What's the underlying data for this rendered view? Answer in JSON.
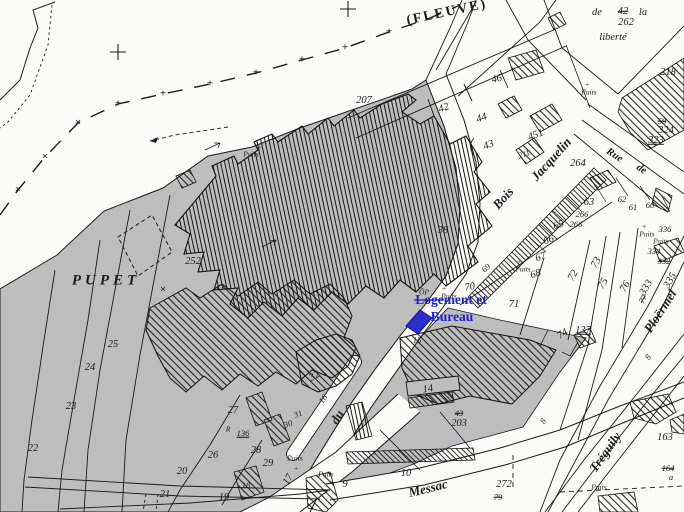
{
  "map": {
    "type": "cadastral-plan-scan",
    "area_name": "PUPET",
    "river_label": "(FLEUVE)",
    "place_labels": {
      "liberte_line1": "de",
      "liberte_old": "42",
      "liberte_line1b": "la",
      "liberte_new": "262",
      "liberte_line2": "liberté"
    },
    "streets": [
      "Bois Jacquelin",
      "Rue de",
      "du",
      "Messac",
      "Tréguily",
      "Ploërmel"
    ],
    "well_label": "Puits"
  },
  "annotation": {
    "line1": "Logement et",
    "line2": "Bureau",
    "color": "#1e22c8"
  },
  "colors": {
    "shade_gray": "#bdbdbd",
    "ink": "#1b1b1b",
    "paper": "#fbfbf8",
    "annotation_blue": "#2a2ecf"
  },
  "map_labels": [
    {
      "name": "river-label",
      "t": "(FLEUVE)",
      "x": 447,
      "y": 13,
      "r": -12,
      "c": "st2"
    },
    {
      "name": "area-label-pupet",
      "t": "PUPET",
      "x": 106,
      "y": 281,
      "r": 0,
      "c": "pupet"
    },
    {
      "name": "boundary-plus",
      "t": "+",
      "x": 118,
      "y": 104,
      "r": 0,
      "c": "mk"
    },
    {
      "name": "boundary-plus",
      "t": "+",
      "x": 163,
      "y": 94,
      "r": 0,
      "c": "mk"
    },
    {
      "name": "boundary-plus",
      "t": "+",
      "x": 210,
      "y": 84,
      "r": 0,
      "c": "mk"
    },
    {
      "name": "boundary-plus",
      "t": "+",
      "x": 256,
      "y": 73,
      "r": 0,
      "c": "mk"
    },
    {
      "name": "boundary-plus",
      "t": "+",
      "x": 302,
      "y": 60,
      "r": 0,
      "c": "mk"
    },
    {
      "name": "boundary-plus",
      "t": "+",
      "x": 345,
      "y": 48,
      "r": 0,
      "c": "mk"
    },
    {
      "name": "boundary-plus",
      "t": "+",
      "x": 389,
      "y": 32,
      "r": 0,
      "c": "mk"
    },
    {
      "name": "boundary-cross",
      "t": "×",
      "x": 18,
      "y": 190,
      "r": 0,
      "c": "mk"
    },
    {
      "name": "boundary-cross",
      "t": "×",
      "x": 45,
      "y": 157,
      "r": 0,
      "c": "mk"
    },
    {
      "name": "boundary-cross",
      "t": "×",
      "x": 78,
      "y": 123,
      "r": 0,
      "c": "mk"
    },
    {
      "name": "survey-cross",
      "t": "×",
      "x": 163,
      "y": 290,
      "r": 0,
      "c": "mk"
    },
    {
      "name": "place-word",
      "t": "de",
      "x": 597,
      "y": 13,
      "r": 0,
      "c": "n"
    },
    {
      "name": "parcel-old",
      "t": "42",
      "x": 623,
      "y": 12,
      "r": 0,
      "c": "n strike"
    },
    {
      "name": "place-word",
      "t": "la",
      "x": 643,
      "y": 13,
      "r": 0,
      "c": "n"
    },
    {
      "name": "parcel",
      "t": "262",
      "x": 626,
      "y": 23,
      "r": 0,
      "c": "n"
    },
    {
      "name": "place-word",
      "t": "liberté",
      "x": 613,
      "y": 38,
      "r": 0,
      "c": "n"
    },
    {
      "name": "parcel",
      "t": "218",
      "x": 668,
      "y": 73,
      "r": 0,
      "c": "n"
    },
    {
      "name": "parcel-old",
      "t": "59",
      "x": 662,
      "y": 121,
      "r": 0,
      "c": "ns strike"
    },
    {
      "name": "parcel",
      "t": "324",
      "x": 666,
      "y": 131,
      "r": 0,
      "c": "n"
    },
    {
      "name": "parcel",
      "t": "323",
      "x": 656,
      "y": 141,
      "r": 0,
      "c": "n u"
    },
    {
      "name": "street-label",
      "t": "Rue",
      "x": 614,
      "y": 156,
      "r": 33,
      "c": "stm"
    },
    {
      "name": "street-label",
      "t": "de",
      "x": 641,
      "y": 170,
      "r": 33,
      "c": "stm"
    },
    {
      "name": "parcel",
      "t": "264",
      "x": 578,
      "y": 164,
      "r": 0,
      "c": "n"
    },
    {
      "name": "parcel",
      "t": "63",
      "x": 589,
      "y": 203,
      "r": 0,
      "c": "n"
    },
    {
      "name": "parcel",
      "t": "266",
      "x": 582,
      "y": 214,
      "r": 0,
      "c": "ns"
    },
    {
      "name": "parcel",
      "t": "266",
      "x": 576,
      "y": 224,
      "r": 0,
      "c": "ns"
    },
    {
      "name": "parcel",
      "t": "62",
      "x": 622,
      "y": 199,
      "r": 0,
      "c": "ns"
    },
    {
      "name": "parcel",
      "t": "61",
      "x": 633,
      "y": 207,
      "r": 0,
      "c": "ns"
    },
    {
      "name": "parcel",
      "t": "60",
      "x": 650,
      "y": 205,
      "r": 0,
      "c": "ns"
    },
    {
      "name": "parcel",
      "t": "336",
      "x": 665,
      "y": 229,
      "r": 0,
      "c": "ns"
    },
    {
      "name": "parcel",
      "t": "334",
      "x": 654,
      "y": 251,
      "r": 0,
      "c": "ns"
    },
    {
      "name": "parcel-old",
      "t": "332",
      "x": 664,
      "y": 261,
      "r": 0,
      "c": "ns strike"
    },
    {
      "name": "well-cross",
      "t": "+",
      "x": 644,
      "y": 226,
      "r": 0,
      "c": "tiny"
    },
    {
      "name": "well-label",
      "t": "Puits",
      "x": 647,
      "y": 234,
      "r": 0,
      "c": "tiny"
    },
    {
      "name": "well-label",
      "t": "Puits",
      "x": 661,
      "y": 241,
      "r": 0,
      "c": "tiny"
    },
    {
      "name": "well-cross",
      "t": "+",
      "x": 587,
      "y": 84,
      "r": 0,
      "c": "tiny"
    },
    {
      "name": "well-label",
      "t": "Puits",
      "x": 589,
      "y": 92,
      "r": 0,
      "c": "tiny"
    },
    {
      "name": "parcel",
      "t": "207",
      "x": 364,
      "y": 101,
      "r": 0,
      "c": "n"
    },
    {
      "name": "parcel",
      "t": "42",
      "x": 444,
      "y": 109,
      "r": -20,
      "c": "n"
    },
    {
      "name": "parcel",
      "t": "44",
      "x": 482,
      "y": 119,
      "r": -20,
      "c": "n"
    },
    {
      "name": "parcel",
      "t": "43",
      "x": 489,
      "y": 146,
      "r": -20,
      "c": "n"
    },
    {
      "name": "parcel",
      "t": "451",
      "x": 536,
      "y": 136,
      "r": -20,
      "c": "n"
    },
    {
      "name": "parcel",
      "t": "211",
      "x": 524,
      "y": 154,
      "r": -20,
      "c": "ns"
    },
    {
      "name": "parcel",
      "t": "46",
      "x": 497,
      "y": 80,
      "r": -15,
      "c": "n"
    },
    {
      "name": "well-cross",
      "t": "+",
      "x": 259,
      "y": 147,
      "r": 0,
      "c": "tiny"
    },
    {
      "name": "well-label",
      "t": "Puits",
      "x": 251,
      "y": 154,
      "r": 0,
      "c": "tiny"
    },
    {
      "name": "parcel",
      "t": "252",
      "x": 193,
      "y": 262,
      "r": 0,
      "c": "n"
    },
    {
      "name": "parcel",
      "t": "38",
      "x": 443,
      "y": 231,
      "r": 0,
      "c": "n"
    },
    {
      "name": "street-label",
      "t": "Bois",
      "x": 503,
      "y": 198,
      "r": -48,
      "c": "st"
    },
    {
      "name": "street-label",
      "t": "Jacquelin",
      "x": 551,
      "y": 159,
      "r": -48,
      "c": "st"
    },
    {
      "name": "parcel",
      "t": "65",
      "x": 559,
      "y": 226,
      "r": -20,
      "c": "n"
    },
    {
      "name": "parcel",
      "t": "66",
      "x": 549,
      "y": 241,
      "r": -20,
      "c": "n"
    },
    {
      "name": "parcel",
      "t": "67",
      "x": 541,
      "y": 258,
      "r": -20,
      "c": "n"
    },
    {
      "name": "parcel",
      "t": "68",
      "x": 536,
      "y": 275,
      "r": -20,
      "c": "n"
    },
    {
      "name": "well-cross",
      "t": "+",
      "x": 519,
      "y": 261,
      "r": 0,
      "c": "tiny"
    },
    {
      "name": "well-label",
      "t": "Puits",
      "x": 523,
      "y": 269,
      "r": 0,
      "c": "tiny"
    },
    {
      "name": "parcel",
      "t": "69",
      "x": 486,
      "y": 268,
      "r": -40,
      "c": "ns"
    },
    {
      "name": "parcel",
      "t": "70",
      "x": 470,
      "y": 288,
      "r": -10,
      "c": "n"
    },
    {
      "name": "parcel",
      "t": "71",
      "x": 514,
      "y": 305,
      "r": 0,
      "c": "n"
    },
    {
      "name": "parcel",
      "t": "72",
      "x": 574,
      "y": 276,
      "r": -60,
      "c": "n"
    },
    {
      "name": "parcel",
      "t": "73",
      "x": 597,
      "y": 263,
      "r": -60,
      "c": "n"
    },
    {
      "name": "parcel",
      "t": "75",
      "x": 604,
      "y": 284,
      "r": -60,
      "c": "n"
    },
    {
      "name": "parcel",
      "t": "76",
      "x": 626,
      "y": 287,
      "r": -60,
      "c": "n"
    },
    {
      "name": "parcel",
      "t": "333",
      "x": 647,
      "y": 288,
      "r": -60,
      "c": "n"
    },
    {
      "name": "parcel-old",
      "t": "77",
      "x": 643,
      "y": 299,
      "r": -60,
      "c": "ns strike"
    },
    {
      "name": "parcel",
      "t": "335",
      "x": 671,
      "y": 281,
      "r": -60,
      "c": "n"
    },
    {
      "name": "parcel",
      "t": "74",
      "x": 563,
      "y": 335,
      "r": -30,
      "c": "n"
    },
    {
      "name": "parcel",
      "t": "137",
      "x": 583,
      "y": 331,
      "r": 0,
      "c": "n u"
    },
    {
      "name": "road-width",
      "t": "8",
      "x": 648,
      "y": 357,
      "r": -57,
      "c": "ns"
    },
    {
      "name": "road-width",
      "t": "8",
      "x": 543,
      "y": 421,
      "r": -57,
      "c": "ns"
    },
    {
      "name": "street-label",
      "t": "Ploërmel",
      "x": 660,
      "y": 311,
      "r": -57,
      "c": "st"
    },
    {
      "name": "street-label",
      "t": "Tréguily",
      "x": 605,
      "y": 452,
      "r": -55,
      "c": "st"
    },
    {
      "name": "street-label",
      "t": "Messac",
      "x": 428,
      "y": 488,
      "r": -14,
      "c": "st"
    },
    {
      "name": "well-label",
      "t": "Puits",
      "x": 599,
      "y": 487,
      "r": 0,
      "c": "tiny"
    },
    {
      "name": "parcel",
      "t": "163",
      "x": 665,
      "y": 438,
      "r": 0,
      "c": "n"
    },
    {
      "name": "parcel-old",
      "t": "164",
      "x": 668,
      "y": 468,
      "r": 0,
      "c": "ns strike"
    },
    {
      "name": "parcel",
      "t": "a",
      "x": 671,
      "y": 477,
      "r": 0,
      "c": "ns"
    },
    {
      "name": "parcel",
      "t": "272",
      "x": 504,
      "y": 485,
      "r": 0,
      "c": "n"
    },
    {
      "name": "parcel-old",
      "t": "79",
      "x": 498,
      "y": 497,
      "r": 0,
      "c": "ns strike"
    },
    {
      "name": "well-label",
      "t": "ÔP",
      "x": 424,
      "y": 292,
      "r": 0,
      "c": "tiny"
    },
    {
      "name": "well-cross",
      "t": "+",
      "x": 444,
      "y": 288,
      "r": 0,
      "c": "tiny"
    },
    {
      "name": "well-label",
      "t": "Puits",
      "x": 449,
      "y": 296,
      "r": 0,
      "c": "tiny"
    },
    {
      "name": "parcel",
      "t": "15",
      "x": 417,
      "y": 340,
      "r": 0,
      "c": "ns"
    },
    {
      "name": "parcel",
      "t": "14",
      "x": 428,
      "y": 390,
      "r": -8,
      "c": "n"
    },
    {
      "name": "parcel-old",
      "t": "43",
      "x": 459,
      "y": 413,
      "r": 0,
      "c": "ns strike"
    },
    {
      "name": "parcel",
      "t": "203",
      "x": 459,
      "y": 424,
      "r": 0,
      "c": "n"
    },
    {
      "name": "parcel",
      "t": "10",
      "x": 406,
      "y": 474,
      "r": 0,
      "c": "n"
    },
    {
      "name": "parcel",
      "t": "9",
      "x": 345,
      "y": 485,
      "r": 0,
      "c": "n"
    },
    {
      "name": "well-label",
      "t": "Puits",
      "x": 326,
      "y": 474,
      "r": 0,
      "c": "tiny"
    },
    {
      "name": "well-cross",
      "t": "+",
      "x": 331,
      "y": 482,
      "r": 0,
      "c": "tiny"
    },
    {
      "name": "parcel",
      "t": "32",
      "x": 315,
      "y": 377,
      "r": -30,
      "c": "n"
    },
    {
      "name": "parcel",
      "t": "31",
      "x": 298,
      "y": 414,
      "r": -20,
      "c": "ns"
    },
    {
      "name": "parcel",
      "t": "30",
      "x": 288,
      "y": 424,
      "r": -20,
      "c": "ns"
    },
    {
      "name": "parcel",
      "t": "27",
      "x": 233,
      "y": 411,
      "r": 0,
      "c": "n"
    },
    {
      "name": "symbol-r",
      "t": "R",
      "x": 228,
      "y": 429,
      "r": 0,
      "c": "tiny"
    },
    {
      "name": "parcel",
      "t": "136",
      "x": 243,
      "y": 433,
      "r": 0,
      "c": "ns u"
    },
    {
      "name": "parcel",
      "t": "28",
      "x": 256,
      "y": 451,
      "r": 0,
      "c": "n"
    },
    {
      "name": "parcel",
      "t": "29",
      "x": 268,
      "y": 464,
      "r": 0,
      "c": "n"
    },
    {
      "name": "parcel",
      "t": "18",
      "x": 246,
      "y": 485,
      "r": 0,
      "c": "ns"
    },
    {
      "name": "parcel",
      "t": "26",
      "x": 213,
      "y": 456,
      "r": 0,
      "c": "n"
    },
    {
      "name": "parcel",
      "t": "20",
      "x": 182,
      "y": 472,
      "r": 0,
      "c": "n"
    },
    {
      "name": "parcel",
      "t": "21",
      "x": 165,
      "y": 495,
      "r": 0,
      "c": "n"
    },
    {
      "name": "parcel",
      "t": "19",
      "x": 224,
      "y": 498,
      "r": 0,
      "c": "n"
    },
    {
      "name": "parcel",
      "t": "22",
      "x": 33,
      "y": 449,
      "r": 0,
      "c": "n"
    },
    {
      "name": "parcel",
      "t": "23",
      "x": 71,
      "y": 407,
      "r": 0,
      "c": "n"
    },
    {
      "name": "parcel",
      "t": "24",
      "x": 90,
      "y": 368,
      "r": 0,
      "c": "n"
    },
    {
      "name": "parcel",
      "t": "25",
      "x": 113,
      "y": 345,
      "r": 0,
      "c": "n"
    },
    {
      "name": "parcel",
      "t": "16",
      "x": 323,
      "y": 399,
      "r": -55,
      "c": "ns"
    },
    {
      "name": "street-label",
      "t": "du",
      "x": 337,
      "y": 417,
      "r": -60,
      "c": "st"
    },
    {
      "name": "parcel",
      "t": "17",
      "x": 289,
      "y": 480,
      "r": -60,
      "c": "n"
    },
    {
      "name": "well-label",
      "t": "Puits",
      "x": 295,
      "y": 458,
      "r": 0,
      "c": "tiny"
    },
    {
      "name": "well-cross",
      "t": "+",
      "x": 296,
      "y": 468,
      "r": 0,
      "c": "tiny"
    }
  ]
}
